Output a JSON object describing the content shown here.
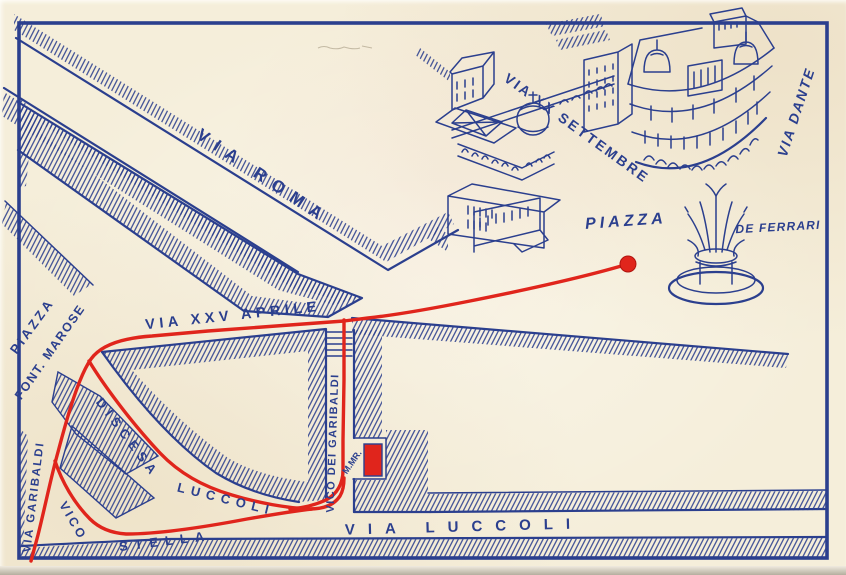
{
  "colors": {
    "paper": "#f5eeda",
    "ink": "#2b3f8e",
    "red": "#e0251c"
  },
  "labels": [
    {
      "id": "via-roma",
      "text": "VIA ROMA",
      "x": 263,
      "y": 177,
      "r": 34,
      "s": 17,
      "ls": 9
    },
    {
      "id": "via-xx-settembre",
      "text": "VIA XX SETTEMBRE",
      "x": 577,
      "y": 128,
      "r": 36,
      "s": 14,
      "ls": 2.5
    },
    {
      "id": "via-dante",
      "text": "VIA DANTE",
      "x": 796,
      "y": 112,
      "r": -72,
      "s": 14,
      "ls": 2,
      "i": 1
    },
    {
      "id": "piazza-de-ferrari-1",
      "text": "PIAZZA",
      "x": 626,
      "y": 222,
      "r": -4,
      "s": 16,
      "ls": 4,
      "i": 1
    },
    {
      "id": "piazza-de-ferrari-2",
      "text": "DE FERRARI",
      "x": 778,
      "y": 227,
      "r": -3,
      "s": 12,
      "ls": 1.2,
      "i": 1
    },
    {
      "id": "piazza-fontane-marose-1",
      "text": "PIAZZA",
      "x": 32,
      "y": 326,
      "r": -54,
      "s": 13,
      "ls": 3
    },
    {
      "id": "piazza-fontane-marose-2",
      "text": "FONT. MAROSE",
      "x": 50,
      "y": 352,
      "r": -55,
      "s": 12.5,
      "ls": 1.5
    },
    {
      "id": "via-xxv-aprile",
      "text": "VIA XXV APRILE",
      "x": 233,
      "y": 316,
      "r": -6,
      "s": 14.5,
      "ls": 4.5
    },
    {
      "id": "discesa-luccoli-1",
      "text": "DISCESA",
      "x": 128,
      "y": 438,
      "r": 53,
      "s": 13,
      "ls": 5.5
    },
    {
      "id": "discesa-luccoli-2",
      "text": "LUCCOLI",
      "x": 226,
      "y": 499,
      "r": 14,
      "s": 13,
      "ls": 6
    },
    {
      "id": "vico-stella-1",
      "text": "VICO",
      "x": 73,
      "y": 521,
      "r": 60,
      "s": 12.5,
      "ls": 3
    },
    {
      "id": "vico-stella-2",
      "text": "STELLA",
      "x": 165,
      "y": 541,
      "r": -7,
      "s": 13,
      "ls": 7
    },
    {
      "id": "via-garibaldi",
      "text": "VIA GARIBALDI",
      "x": 34,
      "y": 497,
      "r": -83,
      "s": 11.5,
      "ls": 2
    },
    {
      "id": "vico-dei-garibaldi",
      "text": "VICO DEI GARIBALDI",
      "x": 333,
      "y": 443,
      "r": -88,
      "s": 11,
      "ls": 1.5
    },
    {
      "id": "mmr",
      "text": "M.MR.",
      "x": 352,
      "y": 462,
      "r": -55,
      "s": 9,
      "ls": 0
    },
    {
      "id": "via-luccoli",
      "text": "VIA LUCCOLI",
      "x": 464,
      "y": 527,
      "r": -1.5,
      "s": 15,
      "ls": 13
    }
  ],
  "route": {
    "color": "#e0251c",
    "dot": {
      "x": 628,
      "y": 264,
      "r": 8
    },
    "marker": {
      "x": 364,
      "y": 444,
      "w": 18,
      "h": 32
    },
    "paths": [
      "M628 264 C585 277 520 291 470 301 C430 309 395 315 368 318 L344 321 L208 331 L152 336 C122 338 101 345 91 359 C79 376 68 414 58 452 C51 477 45 507 38 535 L31 561",
      "M344 320 L344 380 L343 440 L343 470 C343 484 337 494 326 500 C315 505 303 508 290 509",
      "M89 361 C103 384 130 421 160 453 C180 474 204 487 232 495 C258 503 287 508 310 509 C324 509 334 505 340 496 C343 491 344 485 344 478",
      "M55 461 C62 482 74 503 90 519 C99 528 111 533 126 534 C160 534 205 527 247 519 C270 515 293 511 312 509"
    ]
  }
}
